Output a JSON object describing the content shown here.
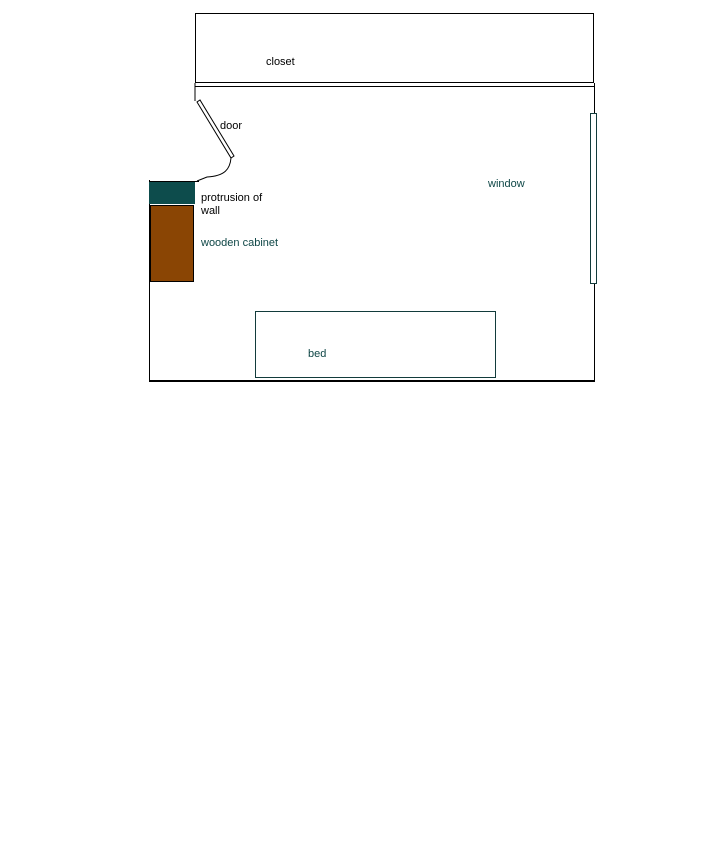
{
  "diagram": {
    "type": "floor-plan-sketch",
    "background": "#ffffff",
    "labels": {
      "closet": "closet",
      "door": "door",
      "protrusion_line1": "protrusion of",
      "protrusion_line2": "wall",
      "wooden_cabinet": "wooden cabinet",
      "window": "window",
      "bed": "bed"
    },
    "colors": {
      "wall_outline": "#000000",
      "protrusion_fill": "#0d4c4c",
      "cabinet_fill": "#8a4504",
      "teal_outline": "#123b3b",
      "teal_text": "#0e4646"
    },
    "objects": [
      {
        "name": "closet",
        "shape": "rectangle",
        "outline": "black"
      },
      {
        "name": "door",
        "shape": "door-swing",
        "outline": "black"
      },
      {
        "name": "protrusion of wall",
        "shape": "filled-rectangle",
        "fill": "#0d4c4c"
      },
      {
        "name": "wooden cabinet",
        "shape": "filled-rectangle",
        "fill": "#8a4504"
      },
      {
        "name": "window",
        "shape": "thin-rectangle",
        "outline": "#123b3b"
      },
      {
        "name": "bed",
        "shape": "rectangle",
        "outline": "#123b3b"
      }
    ]
  }
}
